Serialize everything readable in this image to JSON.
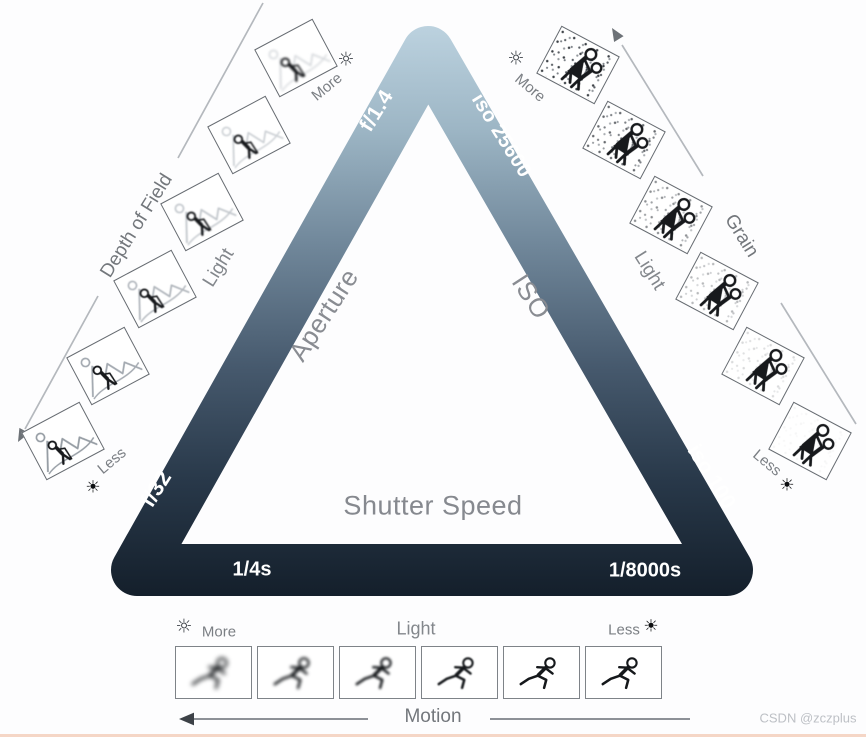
{
  "triangle": {
    "gradient_top_color": "#bcd2df",
    "gradient_bottom_color": "#141f2b",
    "aperture_side": {
      "label": "Aperture",
      "wide_value": "f/1.4",
      "narrow_value": "f/32"
    },
    "iso_side": {
      "label": "ISO",
      "high_value": "iso 25600",
      "low_value": "iso 100"
    },
    "shutter_side": {
      "label": "Shutter Speed",
      "slow_value": "1/4s",
      "fast_value": "1/8000s"
    }
  },
  "dof_scale": {
    "axis_label": "Depth of Field",
    "light_label": "Light",
    "more_label": "More",
    "less_label": "Less"
  },
  "grain_scale": {
    "axis_label": "Grain",
    "light_label": "Light",
    "more_label": "More",
    "less_label": "Less"
  },
  "motion_scale": {
    "axis_label": "Motion",
    "light_label": "Light",
    "more_label": "More",
    "less_label": "Less"
  },
  "icons": {
    "sun_bright": "☼",
    "sun_dark": "☀"
  },
  "colors": {
    "label_gray": "#83878c",
    "axis_gray": "#73777c",
    "value_white": "#ffffff",
    "bottom_bar": "#f5d6c6"
  },
  "watermark": "CSDN @zczplus"
}
